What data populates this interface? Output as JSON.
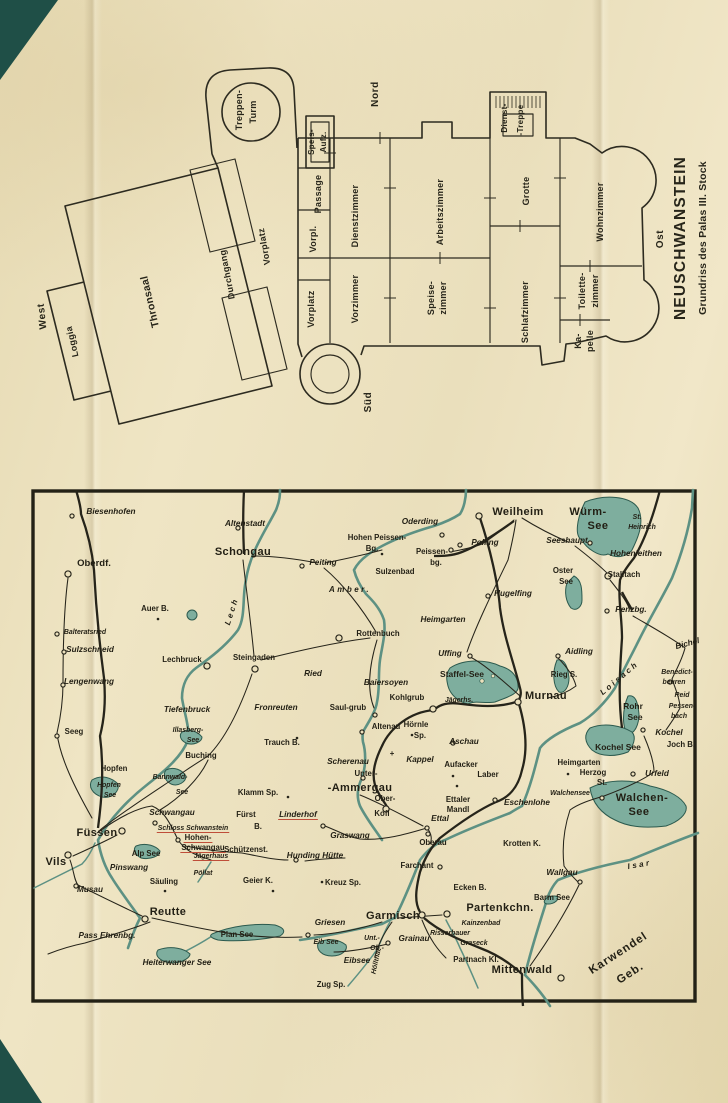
{
  "page": {
    "paper_color": "#eadfbc",
    "ink_color": "#27251a",
    "corner_color": "#1f4f47",
    "water_color": "#7eae9e",
    "accent_red": "#bf4e39"
  },
  "floorplan": {
    "title": "NEUSCHWANSTEIN",
    "subtitle": "Grundriss des Palas III. Stock",
    "compass": {
      "north": "Nord",
      "south": "Süd",
      "west": "West",
      "east": "Ost"
    },
    "labels": [
      {
        "t": "Loggia",
        "x": 45,
        "y": 283,
        "r": -103
      },
      {
        "t": "Thronsaal",
        "x": 123,
        "y": 243,
        "c": "pl-big",
        "r": -103
      },
      {
        "t": "Durchgang",
        "x": 200,
        "y": 216,
        "r": -101
      },
      {
        "t": "Vorplatz",
        "x": 237,
        "y": 188,
        "r": -100
      },
      {
        "t": "Treppen-",
        "x": 212,
        "y": 52
      },
      {
        "t": "Turm",
        "x": 226,
        "y": 54
      },
      {
        "t": "Speis-",
        "x": 284,
        "y": 84,
        "c": "pl-sm"
      },
      {
        "t": "Aufz.",
        "x": 296,
        "y": 84,
        "c": "pl-sm"
      },
      {
        "t": "Passage",
        "x": 291,
        "y": 136
      },
      {
        "t": "Vorpl.",
        "x": 286,
        "y": 181
      },
      {
        "t": "Vorplatz",
        "x": 284,
        "y": 251
      },
      {
        "t": "Dienstzimmer",
        "x": 328,
        "y": 158
      },
      {
        "t": "Vorzimmer",
        "x": 328,
        "y": 241
      },
      {
        "t": "Arbeitszimmer",
        "x": 413,
        "y": 154
      },
      {
        "t": "Speise-",
        "x": 404,
        "y": 240
      },
      {
        "t": "zimmer",
        "x": 416,
        "y": 240
      },
      {
        "t": "Dienst-",
        "x": 477,
        "y": 60,
        "c": "pl-sm"
      },
      {
        "t": "-Treppe",
        "x": 493,
        "y": 62,
        "c": "pl-sm"
      },
      {
        "t": "Grotte",
        "x": 499,
        "y": 133
      },
      {
        "t": "Schlafzimmer",
        "x": 498,
        "y": 254
      },
      {
        "t": "Wohnzimmer",
        "x": 573,
        "y": 154
      },
      {
        "t": "Toilette-",
        "x": 555,
        "y": 233
      },
      {
        "t": "zimmer",
        "x": 568,
        "y": 233
      },
      {
        "t": "Ka-",
        "x": 551,
        "y": 283
      },
      {
        "t": "pelle",
        "x": 563,
        "y": 283
      }
    ]
  },
  "map": {
    "labels": [
      {
        "t": "Biesenhofen",
        "x": 81,
        "y": 26,
        "c": "t-it"
      },
      {
        "t": "Oberdf.",
        "x": 64,
        "y": 78,
        "c": "t-b10"
      },
      {
        "t": "Altenstadt",
        "x": 215,
        "y": 38,
        "c": "t-it"
      },
      {
        "t": "Schongau",
        "x": 213,
        "y": 67,
        "c": "t-big"
      },
      {
        "t": "Hohen Peissen-",
        "x": 347,
        "y": 52,
        "c": "t-med"
      },
      {
        "t": "Bg.",
        "x": 342,
        "y": 63,
        "c": "t-med"
      },
      {
        "t": "Oderding",
        "x": 390,
        "y": 36,
        "c": "t-it"
      },
      {
        "t": "Polling",
        "x": 455,
        "y": 57,
        "c": "t-it"
      },
      {
        "t": "Weilheim",
        "x": 488,
        "y": 27,
        "c": "t-big"
      },
      {
        "t": "Würm-",
        "x": 558,
        "y": 27,
        "c": "t-lake1"
      },
      {
        "t": "See",
        "x": 568,
        "y": 41,
        "c": "t-lake1"
      },
      {
        "t": "St.",
        "x": 607,
        "y": 31,
        "c": "t-sm"
      },
      {
        "t": "Heinrich",
        "x": 612,
        "y": 41,
        "c": "t-sm"
      },
      {
        "t": "Seeshaupt",
        "x": 537,
        "y": 55,
        "c": "t-it"
      },
      {
        "t": "Hohenleithen",
        "x": 606,
        "y": 68,
        "c": "t-it"
      },
      {
        "t": "Oster",
        "x": 533,
        "y": 85,
        "c": "t-med"
      },
      {
        "t": "See",
        "x": 536,
        "y": 96,
        "c": "t-med"
      },
      {
        "t": "Stalltach",
        "x": 594,
        "y": 89,
        "c": "t-med"
      },
      {
        "t": "Peissen-",
        "x": 402,
        "y": 66,
        "c": "t-med"
      },
      {
        "t": "bg.",
        "x": 406,
        "y": 77,
        "c": "t-med"
      },
      {
        "t": "Sulzenbad",
        "x": 365,
        "y": 86,
        "c": "t-med"
      },
      {
        "t": "Peiting",
        "x": 293,
        "y": 77,
        "c": "t-it"
      },
      {
        "t": "Hugelfing",
        "x": 483,
        "y": 108,
        "c": "t-it"
      },
      {
        "t": "Penzbg.",
        "x": 601,
        "y": 124,
        "c": "t-it"
      },
      {
        "t": "Amber.",
        "x": 320,
        "y": 104,
        "c": "t-river",
        "r": 0
      },
      {
        "t": "Auer B.",
        "x": 125,
        "y": 123,
        "c": "t-med"
      },
      {
        "t": "Lech",
        "x": 204,
        "y": 124,
        "c": "t-river",
        "r": -72
      },
      {
        "t": "Heimgarten",
        "x": 413,
        "y": 134,
        "c": "t-it"
      },
      {
        "t": "Balteratsried",
        "x": 55,
        "y": 146,
        "c": "t-sm"
      },
      {
        "t": "Sulzschneid",
        "x": 60,
        "y": 164,
        "c": "t-it"
      },
      {
        "t": "Lengenwang",
        "x": 59,
        "y": 196,
        "c": "t-it"
      },
      {
        "t": "Lechbruck",
        "x": 152,
        "y": 174,
        "c": "t-med"
      },
      {
        "t": "Steingaden",
        "x": 224,
        "y": 172,
        "c": "t-med"
      },
      {
        "t": "Rottenbuch",
        "x": 348,
        "y": 148,
        "c": "t-med"
      },
      {
        "t": "Ried",
        "x": 283,
        "y": 188,
        "c": "t-it"
      },
      {
        "t": "Uffing",
        "x": 420,
        "y": 168,
        "c": "t-it"
      },
      {
        "t": "Staffel-See",
        "x": 432,
        "y": 189,
        "c": "t-lake2"
      },
      {
        "t": "Baiersoyen",
        "x": 356,
        "y": 197,
        "c": "t-it"
      },
      {
        "t": "Aidling",
        "x": 549,
        "y": 166,
        "c": "t-it"
      },
      {
        "t": "Rieg S.",
        "x": 534,
        "y": 189,
        "c": "t-med"
      },
      {
        "t": "Murnau",
        "x": 516,
        "y": 211,
        "c": "t-big"
      },
      {
        "t": "Loisach",
        "x": 591,
        "y": 192,
        "c": "t-river",
        "r": -40
      },
      {
        "t": "Bichel",
        "x": 658,
        "y": 158,
        "c": "t-it",
        "r": -15
      },
      {
        "t": "Benedict-",
        "x": 647,
        "y": 186,
        "c": "t-sm"
      },
      {
        "t": "beuren",
        "x": 644,
        "y": 196,
        "c": "t-sm"
      },
      {
        "t": "Reid",
        "x": 652,
        "y": 209,
        "c": "t-sm"
      },
      {
        "t": "Pessen-",
        "x": 652,
        "y": 220,
        "c": "t-sm"
      },
      {
        "t": "bach",
        "x": 649,
        "y": 230,
        "c": "t-sm"
      },
      {
        "t": "Rohr",
        "x": 603,
        "y": 221,
        "c": "t-lake2"
      },
      {
        "t": "See",
        "x": 605,
        "y": 232,
        "c": "t-lake2"
      },
      {
        "t": "Kochel",
        "x": 639,
        "y": 247,
        "c": "t-it"
      },
      {
        "t": "Kochel See",
        "x": 588,
        "y": 262,
        "c": "t-lake2"
      },
      {
        "t": "Joch B.",
        "x": 651,
        "y": 259,
        "c": "t-med"
      },
      {
        "t": "Fronreuten",
        "x": 246,
        "y": 222,
        "c": "t-it"
      },
      {
        "t": "Saul-grub",
        "x": 318,
        "y": 222,
        "c": "t-med"
      },
      {
        "t": "Kohlgrub",
        "x": 377,
        "y": 212,
        "c": "t-med"
      },
      {
        "t": "Jägerhs.",
        "x": 429,
        "y": 214,
        "c": "t-sm"
      },
      {
        "t": "Hörnle",
        "x": 386,
        "y": 239,
        "c": "t-med"
      },
      {
        "t": "Sp.",
        "x": 390,
        "y": 250,
        "c": "t-med"
      },
      {
        "t": "Altenau",
        "x": 356,
        "y": 241,
        "c": "t-med"
      },
      {
        "t": "Trauch B.",
        "x": 252,
        "y": 257,
        "c": "t-med"
      },
      {
        "t": "Aschau",
        "x": 434,
        "y": 256,
        "c": "t-it"
      },
      {
        "t": "Seeg",
        "x": 44,
        "y": 246,
        "c": "t-med"
      },
      {
        "t": "Tiefenbruck",
        "x": 157,
        "y": 224,
        "c": "t-it"
      },
      {
        "t": "Illasberg-",
        "x": 158,
        "y": 244,
        "c": "t-sm"
      },
      {
        "t": "See",
        "x": 163,
        "y": 254,
        "c": "t-sm"
      },
      {
        "t": "Buching",
        "x": 171,
        "y": 270,
        "c": "t-med"
      },
      {
        "t": "Hopfen",
        "x": 84,
        "y": 283,
        "c": "t-med"
      },
      {
        "t": "Hopfen",
        "x": 79,
        "y": 299,
        "c": "t-sm"
      },
      {
        "t": "See",
        "x": 80,
        "y": 309,
        "c": "t-sm"
      },
      {
        "t": "Bannwald-",
        "x": 140,
        "y": 291,
        "c": "t-sm"
      },
      {
        "t": "See",
        "x": 152,
        "y": 306,
        "c": "t-sm"
      },
      {
        "t": "Scherenau",
        "x": 318,
        "y": 276,
        "c": "t-it"
      },
      {
        "t": "+",
        "x": 362,
        "y": 268,
        "c": "t-med"
      },
      {
        "t": "Kappel",
        "x": 390,
        "y": 274,
        "c": "t-it"
      },
      {
        "t": "Aufacker",
        "x": 431,
        "y": 279,
        "c": "t-med"
      },
      {
        "t": "Laber",
        "x": 458,
        "y": 289,
        "c": "t-med"
      },
      {
        "t": "Unter-",
        "x": 336,
        "y": 288,
        "c": "t-med"
      },
      {
        "t": "-Ammergau",
        "x": 330,
        "y": 303,
        "c": "t-big"
      },
      {
        "t": "Ober-",
        "x": 355,
        "y": 313,
        "c": "t-med"
      },
      {
        "t": "Ettaler",
        "x": 428,
        "y": 314,
        "c": "t-med"
      },
      {
        "t": "Mandl",
        "x": 428,
        "y": 324,
        "c": "t-med"
      },
      {
        "t": "Ettal",
        "x": 410,
        "y": 333,
        "c": "t-it"
      },
      {
        "t": "Eschenlohe",
        "x": 497,
        "y": 317,
        "c": "t-it"
      },
      {
        "t": "Walchensee",
        "x": 540,
        "y": 307,
        "c": "t-sm"
      },
      {
        "t": "Walchen-",
        "x": 612,
        "y": 313,
        "c": "t-lake1"
      },
      {
        "t": "See",
        "x": 609,
        "y": 327,
        "c": "t-lake1"
      },
      {
        "t": "Heimgarten",
        "x": 549,
        "y": 277,
        "c": "t-med"
      },
      {
        "t": "Herzog",
        "x": 563,
        "y": 287,
        "c": "t-med"
      },
      {
        "t": "St.",
        "x": 572,
        "y": 297,
        "c": "t-med"
      },
      {
        "t": "Urfeld",
        "x": 627,
        "y": 288,
        "c": "t-it"
      },
      {
        "t": "Klamm Sp.",
        "x": 228,
        "y": 307,
        "c": "t-med"
      },
      {
        "t": "Fürst",
        "x": 216,
        "y": 329,
        "c": "t-med"
      },
      {
        "t": "B.",
        "x": 228,
        "y": 341,
        "c": "t-med"
      },
      {
        "t": "Linderhof",
        "x": 268,
        "y": 329,
        "c": "t-it",
        "u": 1
      },
      {
        "t": "Kofl",
        "x": 352,
        "y": 328,
        "c": "t-med"
      },
      {
        "t": "Graswang",
        "x": 320,
        "y": 350,
        "c": "t-it"
      },
      {
        "t": "Schützenst.",
        "x": 216,
        "y": 364,
        "c": "t-med"
      },
      {
        "t": "Hunding Hütte",
        "x": 285,
        "y": 370,
        "c": "t-it"
      },
      {
        "t": "Geier K.",
        "x": 228,
        "y": 395,
        "c": "t-med"
      },
      {
        "t": "Kreuz Sp.",
        "x": 313,
        "y": 397,
        "c": "t-med"
      },
      {
        "t": "Oberau",
        "x": 403,
        "y": 357,
        "c": "t-med"
      },
      {
        "t": "Farchant",
        "x": 387,
        "y": 380,
        "c": "t-med"
      },
      {
        "t": "Krotten K.",
        "x": 492,
        "y": 358,
        "c": "t-med"
      },
      {
        "t": "Wallgau",
        "x": 532,
        "y": 387,
        "c": "t-it"
      },
      {
        "t": "Isar",
        "x": 610,
        "y": 379,
        "c": "t-river",
        "r": -10
      },
      {
        "t": "Barm See",
        "x": 522,
        "y": 412,
        "c": "t-med"
      },
      {
        "t": "Ecken B.",
        "x": 440,
        "y": 402,
        "c": "t-med"
      },
      {
        "t": "Garmisch",
        "x": 363,
        "y": 431,
        "c": "t-big"
      },
      {
        "t": "Partenkchn.",
        "x": 470,
        "y": 423,
        "c": "t-big"
      },
      {
        "t": "Kainzenbad",
        "x": 451,
        "y": 437,
        "c": "t-sm"
      },
      {
        "t": "Risserbauer",
        "x": 420,
        "y": 447,
        "c": "t-sm"
      },
      {
        "t": "Graseck",
        "x": 444,
        "y": 457,
        "c": "t-sm"
      },
      {
        "t": "Unt.-",
        "x": 342,
        "y": 452,
        "c": "t-sm"
      },
      {
        "t": "Grainau",
        "x": 384,
        "y": 453,
        "c": "t-it"
      },
      {
        "t": "Ob.-",
        "x": 347,
        "y": 462,
        "c": "t-sm"
      },
      {
        "t": "Griesen",
        "x": 300,
        "y": 437,
        "c": "t-it"
      },
      {
        "t": "Eib See",
        "x": 296,
        "y": 456,
        "c": "t-sm"
      },
      {
        "t": "Eibsee",
        "x": 327,
        "y": 475,
        "c": "t-it"
      },
      {
        "t": "Zug Sp.",
        "x": 301,
        "y": 499,
        "c": "t-med"
      },
      {
        "t": "Höllthal",
        "x": 348,
        "y": 474,
        "c": "t-sm",
        "r": -78
      },
      {
        "t": "Partnach Kl.",
        "x": 446,
        "y": 474,
        "c": "t-med"
      },
      {
        "t": "Mittenwald",
        "x": 492,
        "y": 485,
        "c": "t-big"
      },
      {
        "t": "Karwendel",
        "x": 590,
        "y": 468,
        "c": "t-geb",
        "r": -33
      },
      {
        "t": "Geb.",
        "x": 602,
        "y": 488,
        "c": "t-geb",
        "r": -33
      },
      {
        "t": "Füssen",
        "x": 67,
        "y": 348,
        "c": "t-big"
      },
      {
        "t": "Vils",
        "x": 26,
        "y": 377,
        "c": "t-big"
      },
      {
        "t": "Musau",
        "x": 60,
        "y": 404,
        "c": "t-it"
      },
      {
        "t": "Reutte",
        "x": 138,
        "y": 427,
        "c": "t-big"
      },
      {
        "t": "Pinswang",
        "x": 99,
        "y": 382,
        "c": "t-it"
      },
      {
        "t": "Säuling",
        "x": 134,
        "y": 396,
        "c": "t-med"
      },
      {
        "t": "Schwangau",
        "x": 142,
        "y": 327,
        "c": "t-it"
      },
      {
        "t": "Schloss Schwanstein",
        "x": 163,
        "y": 342,
        "c": "t-sm",
        "u": 1
      },
      {
        "t": "Hohen-",
        "x": 168,
        "y": 352,
        "c": "t-med",
        "u": 1
      },
      {
        "t": "Schwangau",
        "x": 173,
        "y": 362,
        "c": "t-med",
        "u": 1
      },
      {
        "t": "Alp See",
        "x": 116,
        "y": 368,
        "c": "t-med"
      },
      {
        "t": "Jägerhaus",
        "x": 181,
        "y": 370,
        "c": "t-sm",
        "u": 1
      },
      {
        "t": "Pöllat",
        "x": 173,
        "y": 387,
        "c": "t-sm"
      },
      {
        "t": "Pass Ehrenbg.",
        "x": 77,
        "y": 450,
        "c": "t-it"
      },
      {
        "t": "Plan See",
        "x": 207,
        "y": 449,
        "c": "t-med"
      },
      {
        "t": "Heiterwanger See",
        "x": 147,
        "y": 477,
        "c": "t-it"
      }
    ],
    "towns": [
      [
        42,
        28
      ],
      [
        38,
        86,
        1
      ],
      [
        208,
        40
      ],
      [
        272,
        78
      ],
      [
        430,
        57
      ],
      [
        412,
        47
      ],
      [
        421,
        62
      ],
      [
        449,
        28,
        1
      ],
      [
        560,
        55
      ],
      [
        578,
        88,
        1
      ],
      [
        577,
        123
      ],
      [
        458,
        108
      ],
      [
        309,
        150,
        1
      ],
      [
        225,
        181,
        1
      ],
      [
        177,
        178,
        1
      ],
      [
        33,
        197
      ],
      [
        34,
        164
      ],
      [
        27,
        146
      ],
      [
        27,
        248
      ],
      [
        92,
        343,
        1
      ],
      [
        38,
        367,
        1
      ],
      [
        46,
        398
      ],
      [
        115,
        431,
        1
      ],
      [
        125,
        335
      ],
      [
        148,
        352
      ],
      [
        278,
        447
      ],
      [
        392,
        427,
        1
      ],
      [
        417,
        426,
        1
      ],
      [
        358,
        455
      ],
      [
        531,
        490,
        1
      ],
      [
        550,
        394
      ],
      [
        572,
        310
      ],
      [
        603,
        286
      ],
      [
        613,
        242
      ],
      [
        465,
        312
      ],
      [
        398,
        346
      ],
      [
        410,
        379
      ],
      [
        397,
        340
      ],
      [
        345,
        227
      ],
      [
        403,
        221,
        1
      ],
      [
        332,
        244
      ],
      [
        440,
        168
      ],
      [
        488,
        214,
        1
      ],
      [
        528,
        168
      ],
      [
        423,
        255
      ],
      [
        640,
        194
      ],
      [
        266,
        372
      ],
      [
        293,
        338
      ],
      [
        356,
        321,
        1
      ],
      [
        333,
        290
      ]
    ],
    "peaks": [
      [
        128,
        131
      ],
      [
        267,
        250
      ],
      [
        382,
        247
      ],
      [
        292,
        394
      ],
      [
        135,
        403
      ],
      [
        243,
        403
      ],
      [
        427,
        298
      ],
      [
        423,
        288
      ],
      [
        538,
        286
      ],
      [
        352,
        66
      ],
      [
        258,
        309
      ]
    ]
  }
}
